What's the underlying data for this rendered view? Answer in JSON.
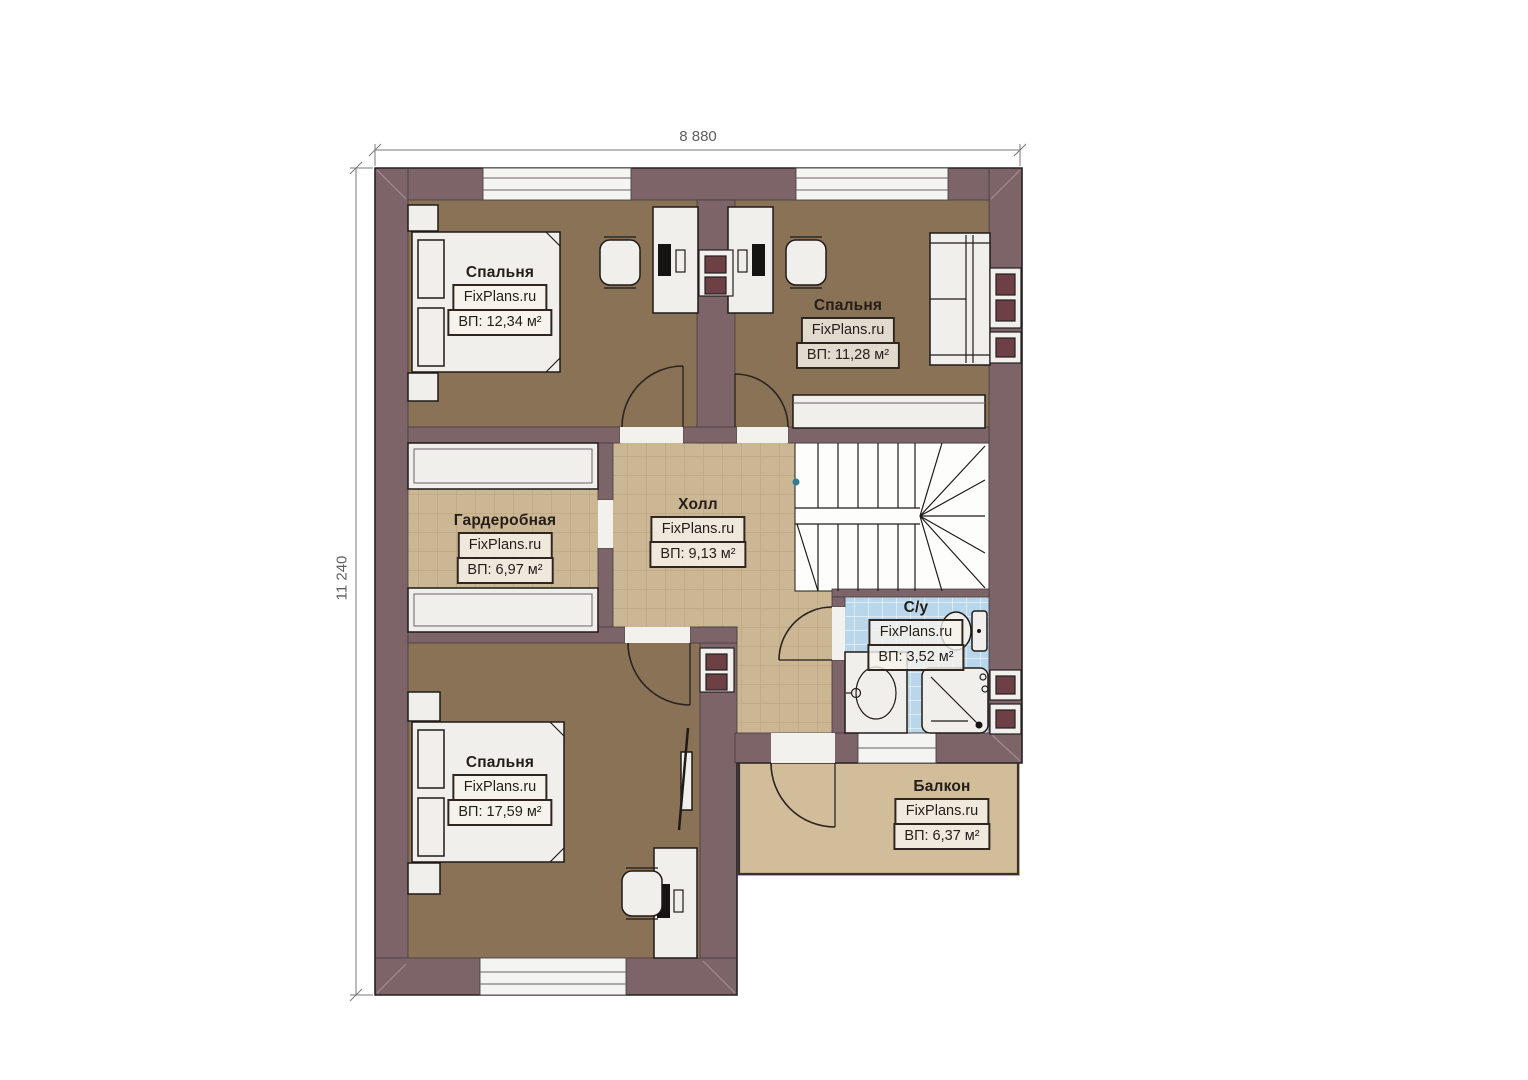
{
  "dimensions": {
    "width": "8 880",
    "height": "11 240"
  },
  "rooms": [
    {
      "id": "bedroom-top-left",
      "name": "Спальня",
      "brand": "FixPlans.ru",
      "area": "ВП: 12,34 м²"
    },
    {
      "id": "bedroom-top-right",
      "name": "Спальня",
      "brand": "FixPlans.ru",
      "area": "ВП: 11,28 м²"
    },
    {
      "id": "wardrobe",
      "name": "Гардеробная",
      "brand": "FixPlans.ru",
      "area": "ВП: 6,97 м²"
    },
    {
      "id": "hall",
      "name": "Холл",
      "brand": "FixPlans.ru",
      "area": "ВП: 9,13 м²"
    },
    {
      "id": "bathroom",
      "name": "С/у",
      "brand": "FixPlans.ru",
      "area": "ВП: 3,52 м²"
    },
    {
      "id": "bedroom-bottom",
      "name": "Спальня",
      "brand": "FixPlans.ru",
      "area": "ВП: 17,59 м²"
    },
    {
      "id": "balcony",
      "name": "Балкон",
      "brand": "FixPlans.ru",
      "area": "ВП: 6,37 м²"
    }
  ],
  "colors": {
    "wall": "#7c6468",
    "bedroom_floor": "#8a7256",
    "tile_floor": "#ccb794",
    "bathroom_floor": "#b9d6ea",
    "balcony_floor": "#d2bd9b",
    "furniture": "#f0efec",
    "outline": "#1f1b18",
    "vent_shaft": "#6d4046",
    "dimension_text": "#5f5f5f"
  }
}
